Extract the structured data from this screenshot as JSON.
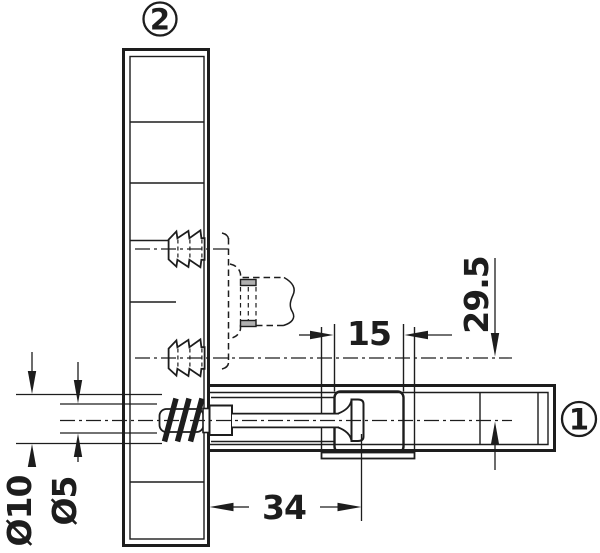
{
  "drawing": {
    "title": "connector-fitting-technical-drawing",
    "balloons": {
      "vertical_panel": "2",
      "horizontal_panel": "1"
    },
    "dimensions": {
      "vertical_offset": "29.5",
      "cam_hole_width": "15",
      "drilling_distance": "34",
      "dowel_hole_diameter": "Ø10",
      "pilot_hole_diameter": "Ø5"
    },
    "colors": {
      "line": "#1d1d1d",
      "background": "#ffffff",
      "slot_fill": "#b0b0b0"
    }
  }
}
